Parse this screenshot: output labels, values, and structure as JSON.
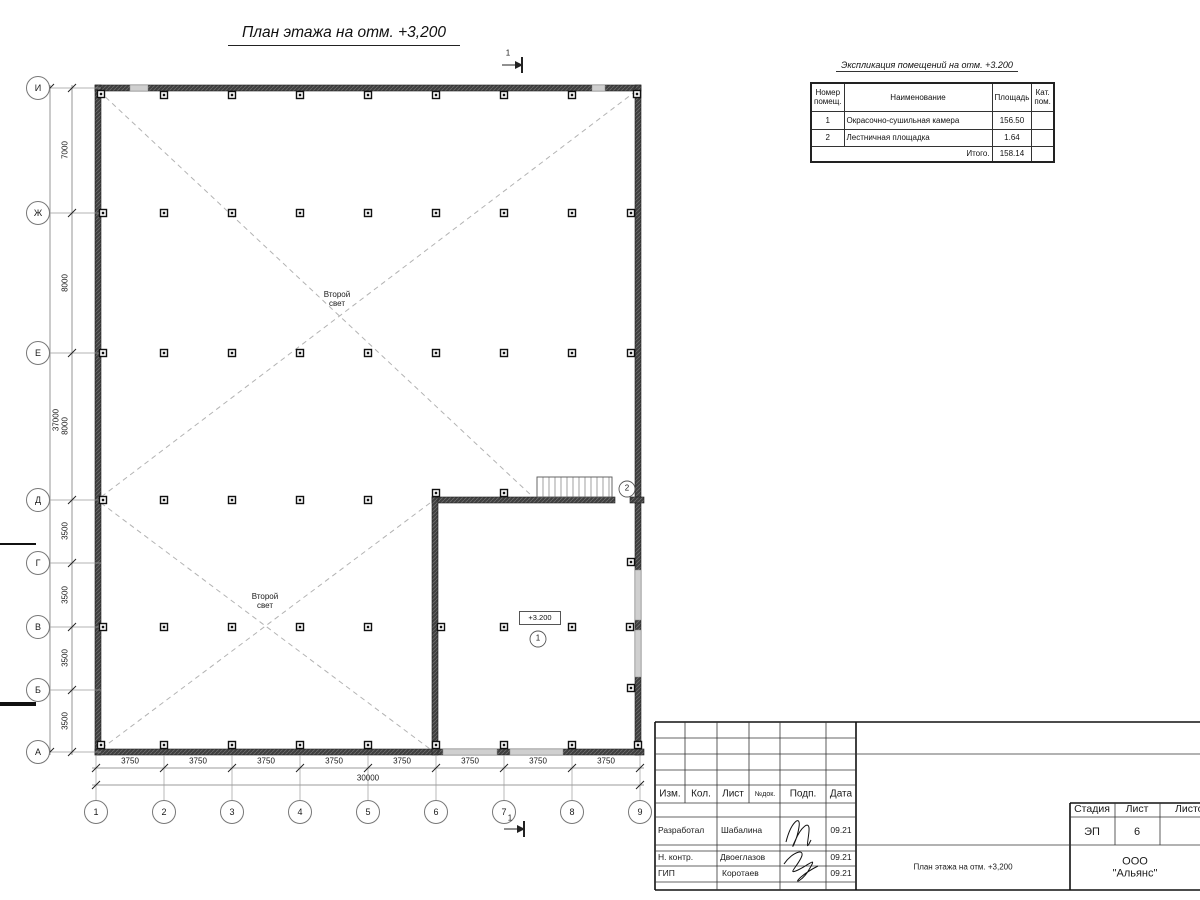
{
  "title": "План этажа на отм. +3,200",
  "schedule": {
    "title": "Экспликация помещений на отм. +3.200",
    "headers": {
      "num": "Номер\nпомещ.",
      "name": "Наименование",
      "area": "Площадь",
      "cat": "Кат.\nпом."
    },
    "rows": [
      {
        "num": "1",
        "name": "Окрасочно-сушильная камера",
        "area": "156.50",
        "cat": ""
      },
      {
        "num": "2",
        "name": "Лестничная площадка",
        "area": "1.64",
        "cat": ""
      }
    ],
    "total_label": "Итого.",
    "total_value": "158.14"
  },
  "plan": {
    "axes_v": [
      "И",
      "Ж",
      "Е",
      "Д",
      "Г",
      "В",
      "Б",
      "А"
    ],
    "axes_h": [
      "1",
      "2",
      "3",
      "4",
      "5",
      "6",
      "7",
      "8",
      "9"
    ],
    "dims_v": [
      "7000",
      "8000",
      "8000",
      "3500",
      "3500",
      "3500",
      "3500"
    ],
    "dims_v_total": "37000",
    "dims_h": [
      "3750",
      "3750",
      "3750",
      "3750",
      "3750",
      "3750",
      "3750",
      "3750"
    ],
    "dims_h_total": "30000",
    "second_light": "Второй\nсвет",
    "elevation_mark": "+3.200",
    "room_tags": [
      "1",
      "2"
    ],
    "section_mark": "1"
  },
  "titleblock": {
    "cols": {
      "izm": "Изм.",
      "kol": "Кол.",
      "list": "Лист",
      "ndok": "№док.",
      "podp": "Подп.",
      "data": "Дата"
    },
    "rows": [
      {
        "role": "Разработал",
        "name": "Шабалина",
        "date": "09.21"
      },
      {
        "role": "Н. контр.",
        "name": "Двоеглазов",
        "date": "09.21"
      },
      {
        "role": "ГИП",
        "name": "Коротаев",
        "date": "09.21"
      }
    ],
    "doc_title": "План этажа на отм. +3,200",
    "stage_label": "Стадия",
    "stage_value": "ЭП",
    "sheet_label": "Лист",
    "sheet_value": "6",
    "sheets_label": "Листов",
    "company": "ООО \"Альянс\""
  }
}
